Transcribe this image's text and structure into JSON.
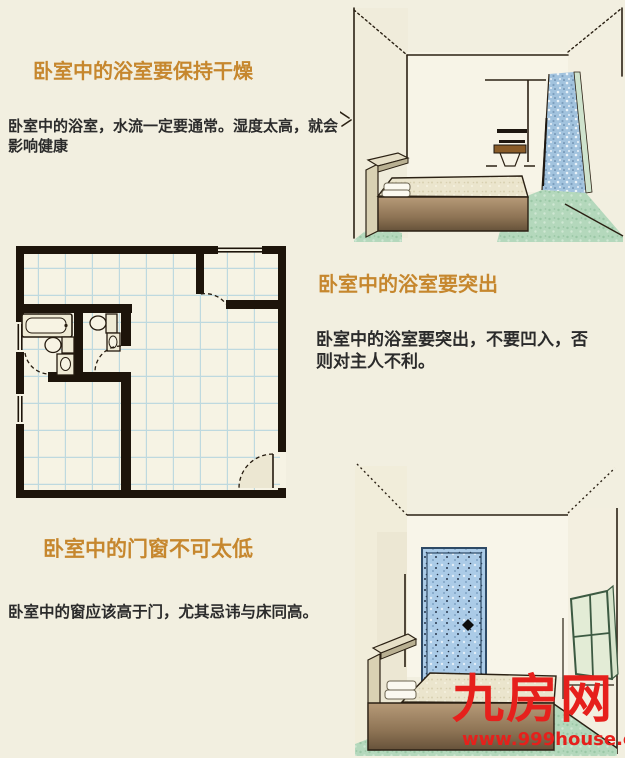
{
  "canvas": {
    "background": "#f2efe0",
    "width": 625,
    "height": 758
  },
  "sections": [
    {
      "title": "卧室中的浴室要保持干燥",
      "lines": [
        "卧室中的浴室，水流一定要通常。湿度太高，就会",
        "影响健康"
      ]
    },
    {
      "title": "卧室中的浴室要突出",
      "lines": [
        "卧室中的浴室要突出，不要凹入，否",
        "则对主人不利。"
      ]
    },
    {
      "title": "卧室中的门窗不可太低",
      "lines": [
        "卧室中的窗应该高于门，尤其忌讳与床同高。"
      ]
    }
  ],
  "illustrations": [
    {
      "name": "bedroom-with-open-bathroom",
      "elements": [
        "bed",
        "toilet-niche",
        "blue-mosaic-wall",
        "green-floor"
      ]
    },
    {
      "name": "bathroom-floor-plan",
      "elements": [
        "bathtub",
        "toilets",
        "sink",
        "door-swing-arcs",
        "tiled-floor",
        "windows"
      ]
    },
    {
      "name": "bedroom-with-blue-door",
      "elements": [
        "bed",
        "blue-speckled-door",
        "open-window",
        "green-floor"
      ]
    }
  ],
  "watermark": {
    "site_name": "九房网",
    "site_url": "www.999house.com",
    "color": "#e6201c"
  },
  "colors": {
    "title_orange": "#c6872e",
    "body_text": "#2b2b2b",
    "plan_wall": "#1d140a",
    "tile_line_blue": "#bed9df",
    "mosaic_blue": "#a2c3de",
    "door_blue": "#abcbe7",
    "floor_green": "#b4d8bc",
    "bed_brown": "#8d7354"
  }
}
